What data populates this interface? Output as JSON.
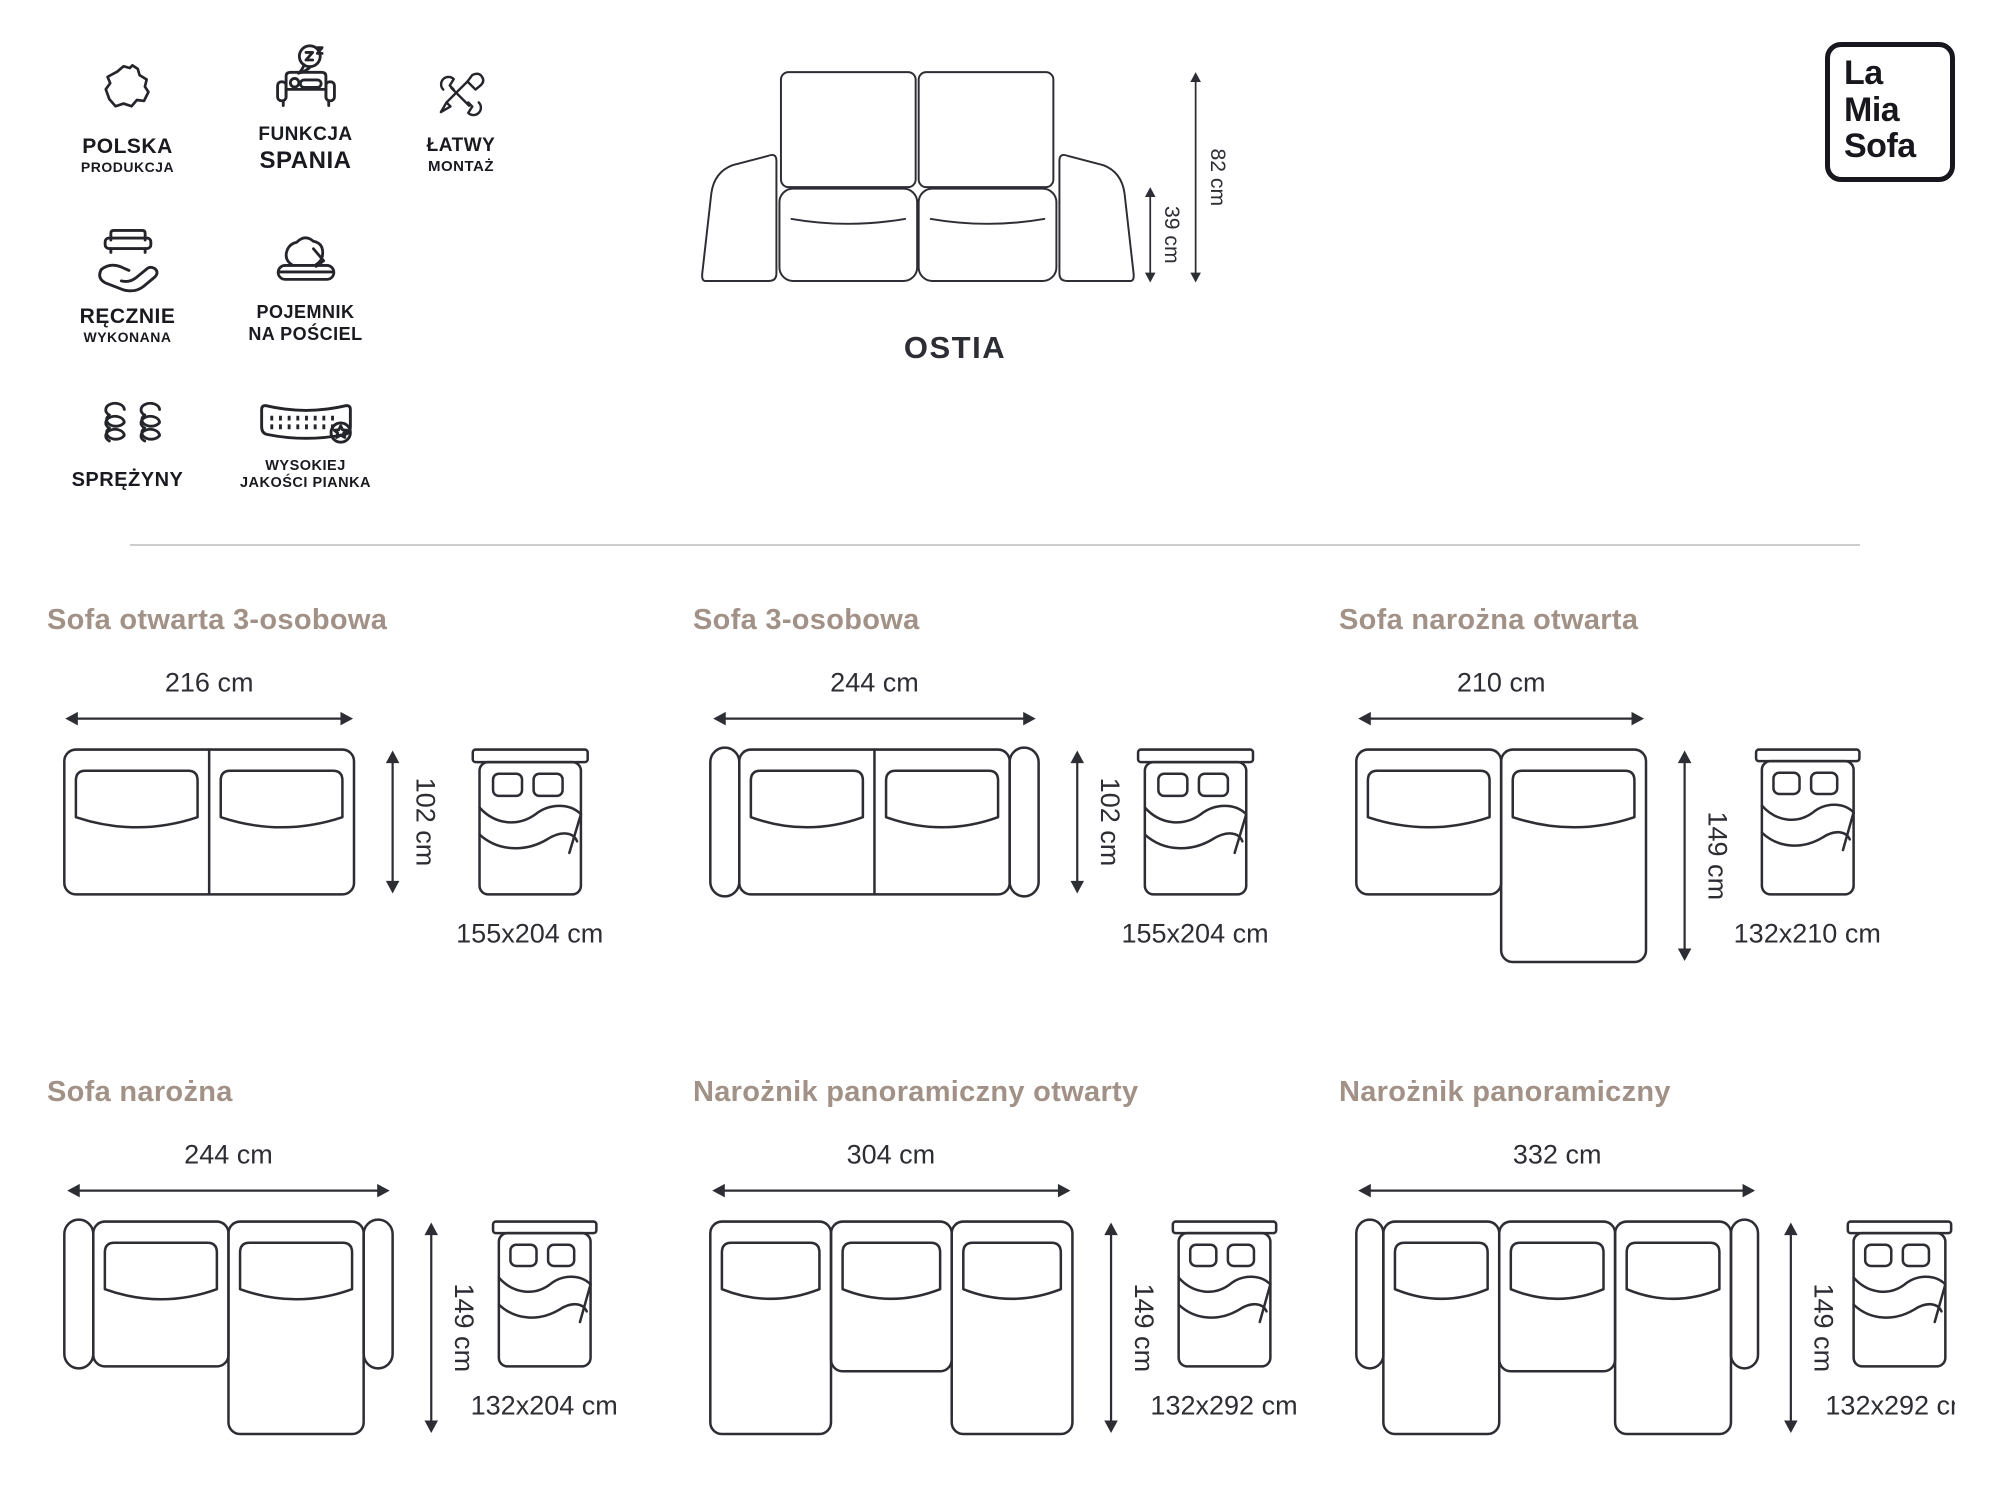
{
  "logo": {
    "line1": "La",
    "line2": "Mia",
    "line3": "Sofa"
  },
  "product": {
    "title": "OSTIA",
    "height": "82 cm",
    "seat_height": "39 cm"
  },
  "features": [
    {
      "icon": "poland-map",
      "line1": "POLSKA",
      "line2": "PRODUKCJA"
    },
    {
      "icon": "sleep-function",
      "line1": "FUNKCJA",
      "line2": "SPANIA"
    },
    {
      "icon": "easy-assembly-tools",
      "line1": "ŁATWY",
      "line2": "MONTAŻ"
    },
    {
      "icon": "handmade",
      "line1": "RĘCZNIE",
      "line2": "WYKONANA"
    },
    {
      "icon": "bedding-storage",
      "line1": "POJEMNIK",
      "line2": "NA POŚCIEL"
    },
    {
      "icon": "springs",
      "line1": "SPRĘŻYNY",
      "line2": ""
    },
    {
      "icon": "high-quality-foam",
      "line1": "WYSOKIEJ",
      "line2": "JAKOŚCI PIANKA"
    }
  ],
  "configurations": [
    {
      "title": "Sofa otwarta 3-osobowa",
      "width": "216 cm",
      "depth": "102 cm",
      "bed_size": "155x204 cm"
    },
    {
      "title": "Sofa 3-osobowa",
      "width": "244 cm",
      "depth": "102 cm",
      "bed_size": "155x204 cm"
    },
    {
      "title": "Sofa narożna otwarta",
      "width": "210 cm",
      "depth": "149 cm",
      "bed_size": "132x210 cm"
    },
    {
      "title": "Sofa narożna",
      "width": "244 cm",
      "depth": "149 cm",
      "bed_size": "132x204 cm"
    },
    {
      "title": "Narożnik panoramiczny otwarty",
      "width": "304 cm",
      "depth": "149 cm",
      "bed_size": "132x292 cm"
    },
    {
      "title": "Narożnik panoramiczny",
      "width": "332 cm",
      "depth": "149 cm",
      "bed_size": "132x292 cm"
    }
  ],
  "colors": {
    "ink": "#2d2d34",
    "heading": "#a29186",
    "divider": "#cfcccc"
  }
}
